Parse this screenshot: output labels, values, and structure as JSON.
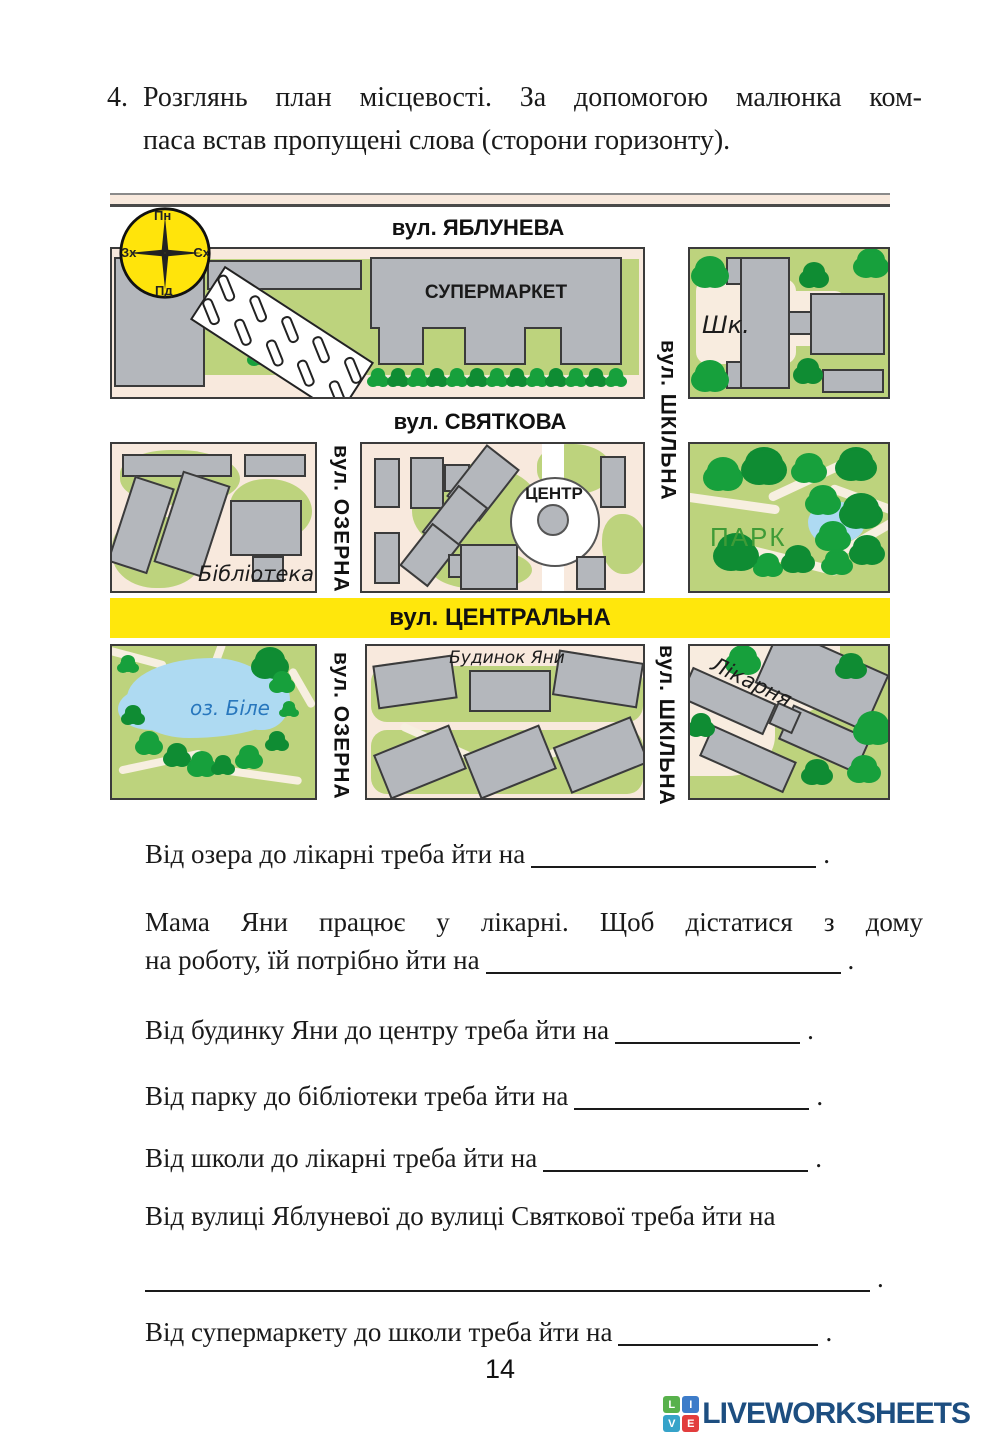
{
  "task": {
    "number": "4.",
    "instruction_line1": "Розглянь план місцевості. За допомогою малюнка ком-",
    "instruction_line2": "паса встав пропущені слова (сторони горизонту)."
  },
  "compass": {
    "north": "Пн",
    "east": "Сх",
    "south": "Пд",
    "west": "Зх"
  },
  "map": {
    "streets": {
      "yabluneva": "вул. ЯБЛУНЕВА",
      "svyatkova": "вул. СВЯТКОВА",
      "tsentralna": "вул. ЦЕНТРАЛЬНА",
      "shkilna": "вул. ШКІЛЬНА",
      "ozerna": "вул. ОЗЕРНА"
    },
    "places": {
      "supermarket": "СУПЕРМАРКЕТ",
      "school": "Шк.",
      "library": "Бібліотека",
      "center": "ЦЕНТР",
      "park": "ПАРК",
      "lake": "оз. Біле",
      "yana_house": "Будинок Яни",
      "hospital": "Лікарня"
    },
    "colors": {
      "street_yellow": "#ffe70c",
      "block_pink": "#f8e9dd",
      "grass_green": "#bdd37d",
      "tree_green": "#17a03c",
      "building_gray": "#b4b7bc",
      "water_blue": "#aedaf2",
      "compass_yellow": "#ffe40b",
      "park_label_green": "#3f9b37",
      "lake_label_blue": "#2877bd"
    }
  },
  "questions": [
    {
      "text": "Від озера до лікарні треба йти на"
    },
    {
      "line1": "Мама Яни працює у лікарні. Щоб дістатися з дому",
      "line2": "на роботу, їй потрібно йти на"
    },
    {
      "text": "Від будинку Яни до центру треба йти на"
    },
    {
      "text": "Від парку до бібліотеки треба йти на"
    },
    {
      "text": "Від школи до лікарні треба йти на"
    },
    {
      "text": "Від вулиці Яблуневої до вулиці Святкової треба йти на"
    },
    {
      "text": "Від супермаркету до школи треба йти на"
    }
  ],
  "punctuation": {
    "period": "."
  },
  "footer": {
    "page_number": "14",
    "logo": {
      "text": "LIVEWORKSHEETS",
      "blocks": [
        "L",
        "I",
        "V",
        "E"
      ]
    }
  }
}
